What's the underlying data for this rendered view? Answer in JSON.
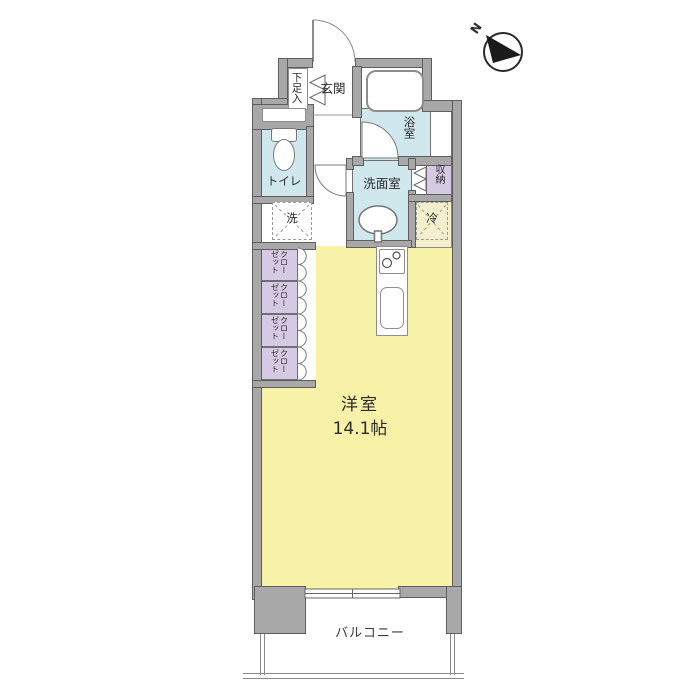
{
  "plan": {
    "type": "floor-plan",
    "compass": {
      "label": "N"
    },
    "rooms": {
      "shoe_box": {
        "label": "下足入"
      },
      "entrance": {
        "label": "玄関"
      },
      "bath": {
        "label": "浴室"
      },
      "washroom": {
        "label": "洗面室"
      },
      "storage": {
        "label": "収納"
      },
      "toilet": {
        "label": "トイレ"
      },
      "washer": {
        "label": "洗"
      },
      "fridge": {
        "label": "冷"
      },
      "closet": {
        "line_right": "クロー",
        "line_left": "ゼット"
      },
      "living": {
        "label": "洋室",
        "size": "14.1帖"
      },
      "balcony": {
        "label": "バルコニー"
      }
    },
    "colors": {
      "wall": "#a8a8a8",
      "wall_edge": "#5e5e5e",
      "wet_area_blue": "#cfe7ed",
      "closet_lavender": "#d5c9e4",
      "living_yellow": "#f7f2a7",
      "fridge_nook_pale_yellow": "#f4f0cd",
      "background": "#ffffff"
    }
  }
}
